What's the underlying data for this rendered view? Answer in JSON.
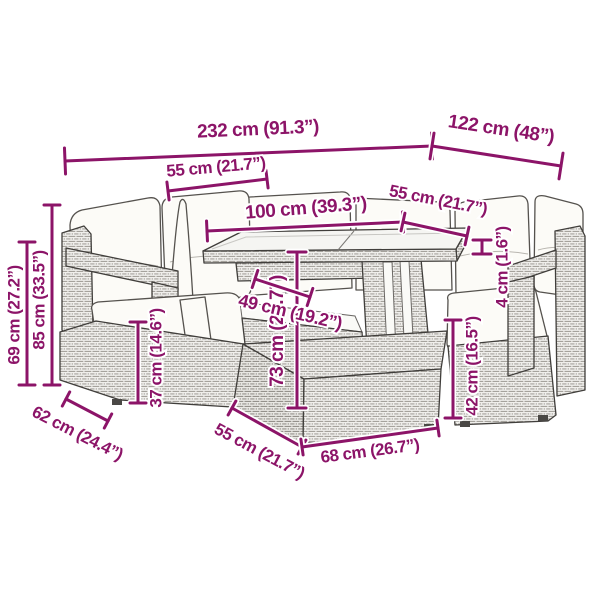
{
  "page": {
    "background": "#ffffff",
    "accent": "#8c1468",
    "outline": "#403e3b",
    "subject": "rattan-lounge-set-line-drawing"
  },
  "diagram": {
    "type": "product-dimensions",
    "dimensions": [
      {
        "id": "overall-width",
        "label": "232 cm (91.3”)",
        "x1": 65,
        "y1": 161,
        "x2": 432,
        "y2": 146,
        "tick": 26,
        "tx": 258,
        "ty": 130,
        "rot": -2.5,
        "size": 19
      },
      {
        "id": "overall-depth",
        "label": "122 cm (48”)",
        "x1": 432,
        "y1": 146,
        "x2": 561,
        "y2": 166,
        "tick": 26,
        "tx": 501,
        "ty": 130,
        "rot": 8.5,
        "size": 19
      },
      {
        "id": "backrest-width",
        "label": "55 cm (21.7”)",
        "x1": 168,
        "y1": 191,
        "x2": 267,
        "y2": 179,
        "tick": 18,
        "tx": 216,
        "ty": 168,
        "rot": -5,
        "size": 17
      },
      {
        "id": "table-length",
        "label": "100 cm (39.3”)",
        "x1": 207,
        "y1": 231,
        "x2": 403,
        "y2": 222,
        "tick": 20,
        "tx": 306,
        "ty": 209,
        "rot": -4.5,
        "size": 19
      },
      {
        "id": "seat-width",
        "label": "55 cm (21.7”)",
        "x1": 403,
        "y1": 222,
        "x2": 467,
        "y2": 236,
        "tick": 18,
        "tx": 438,
        "ty": 201,
        "rot": 11,
        "size": 17
      },
      {
        "id": "glass-thickness",
        "label": "4 cm (1.6”)",
        "x1": 482,
        "y1": 240,
        "x2": 482,
        "y2": 254,
        "tick": 18,
        "tx": 503,
        "ty": 267,
        "rot": -90,
        "size": 17
      },
      {
        "id": "armrest-height",
        "label": "69 cm (27.2”)",
        "x1": 27,
        "y1": 242,
        "x2": 27,
        "y2": 385,
        "tick": 16,
        "tx": 15,
        "ty": 315,
        "rot": -90,
        "size": 17
      },
      {
        "id": "backrest-height",
        "label": "85 cm (33.5”)",
        "x1": 52,
        "y1": 205,
        "x2": 52,
        "y2": 385,
        "tick": 16,
        "tx": 40,
        "ty": 300,
        "rot": -90,
        "size": 17
      },
      {
        "id": "seat-height",
        "label": "37 cm (14.6”)",
        "x1": 138,
        "y1": 322,
        "x2": 138,
        "y2": 403,
        "tick": 16,
        "tx": 157,
        "ty": 358,
        "rot": -90,
        "size": 17
      },
      {
        "id": "table-height",
        "label": "73 cm (28.7”)",
        "x1": 297,
        "y1": 252,
        "x2": 297,
        "y2": 408,
        "tick": 18,
        "tx": 278,
        "ty": 331,
        "rot": -90,
        "size": 19
      },
      {
        "id": "ottoman-height",
        "label": "42 cm (16.5”)",
        "x1": 453,
        "y1": 320,
        "x2": 453,
        "y2": 418,
        "tick": 16,
        "tx": 473,
        "ty": 366,
        "rot": -90,
        "size": 17
      },
      {
        "id": "shelf-depth",
        "label": "49 cm (19.2”)",
        "x1": 255,
        "y1": 279,
        "x2": 310,
        "y2": 297,
        "tick": 18,
        "tx": 290,
        "ty": 313,
        "rot": 13,
        "size": 18
      },
      {
        "id": "side-depth",
        "label": "62 cm (24.4”)",
        "x1": 66,
        "y1": 399,
        "x2": 108,
        "y2": 421,
        "tick": 16,
        "tx": 77,
        "ty": 434,
        "rot": 27,
        "size": 17
      },
      {
        "id": "ottoman-depth",
        "label": "55 cm (21.7”)",
        "x1": 232,
        "y1": 408,
        "x2": 302,
        "y2": 447,
        "tick": 16,
        "tx": 259,
        "ty": 452,
        "rot": 28,
        "size": 17
      },
      {
        "id": "ottoman-width",
        "label": "68 cm (26.7”)",
        "x1": 302,
        "y1": 447,
        "x2": 438,
        "y2": 428,
        "tick": 16,
        "tx": 370,
        "ty": 452,
        "rot": -7.5,
        "size": 17
      }
    ]
  }
}
